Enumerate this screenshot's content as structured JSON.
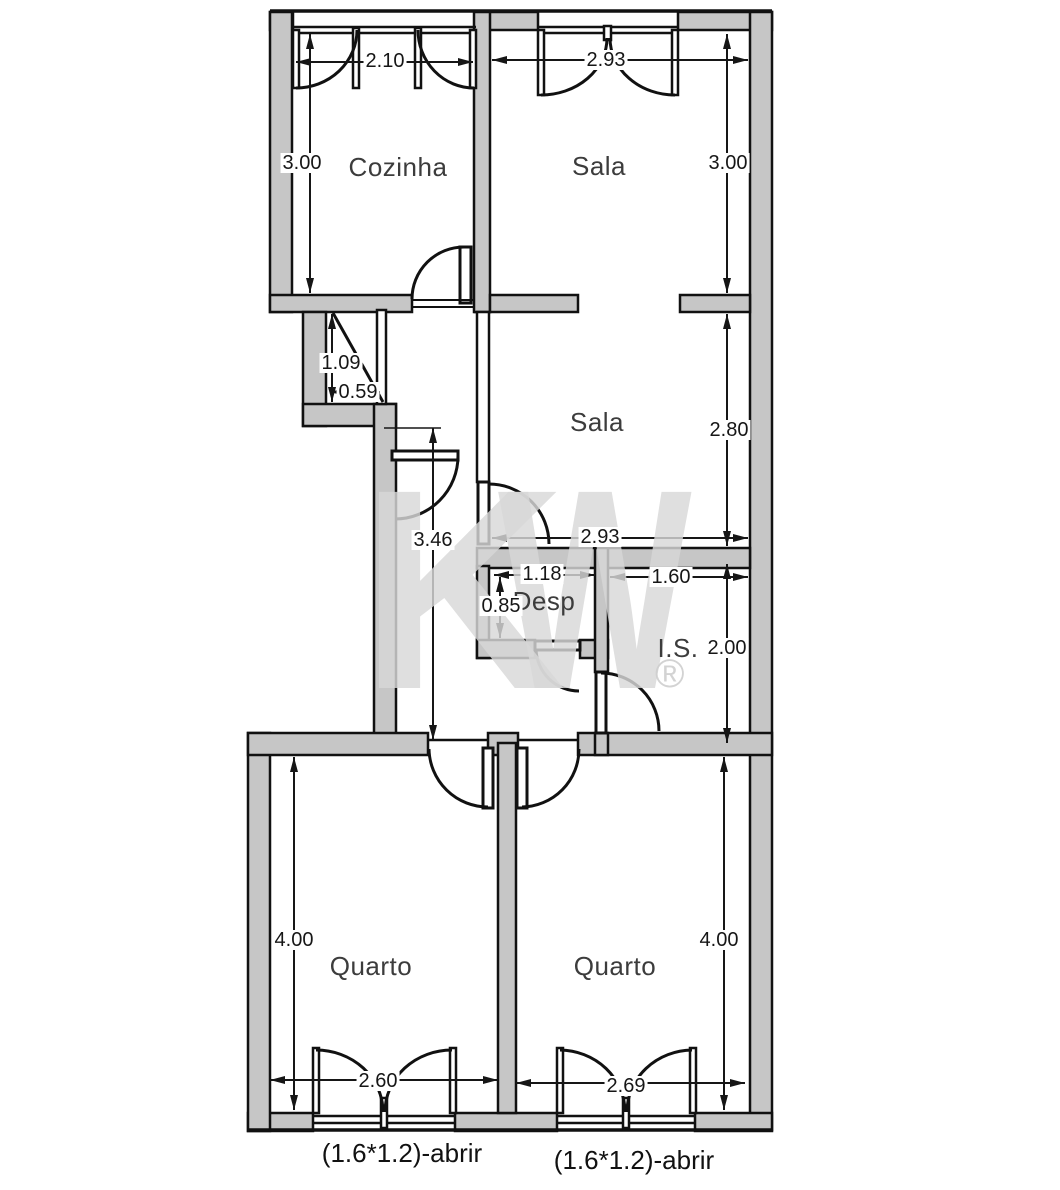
{
  "watermark": {
    "k": "K",
    "w": "W",
    "registered": "®"
  },
  "rooms": {
    "cozinha": "Cozinha",
    "sala_top": "Sala",
    "sala_mid": "Sala",
    "desp": "Desp",
    "is": "I.S.",
    "quarto_left": "Quarto",
    "quarto_right": "Quarto"
  },
  "dimensions": {
    "cozinha_width": "2.10",
    "sala_top_width": "2.93",
    "cozinha_height": "3.00",
    "sala_top_height": "3.00",
    "vestibule_depth": "1.09",
    "vestibule_width": "0.59",
    "sala_mid_height": "2.80",
    "corridor_length": "3.46",
    "sala_mid_width": "2.93",
    "desp_width": "1.18",
    "desp_height": "0.85",
    "is_width": "1.60",
    "is_height": "2.00",
    "quarto_left_height": "4.00",
    "quarto_right_height": "4.00",
    "quarto_left_width": "2.60",
    "quarto_right_width": "2.69"
  },
  "annotations": {
    "window_left": "(1.6*1.2)-abrir",
    "window_right": "(1.6*1.2)-abrir"
  },
  "colors": {
    "wall_fill": "#c6c6c6",
    "line": "#111111",
    "watermark": "#d8d8d8",
    "background": "#ffffff"
  }
}
